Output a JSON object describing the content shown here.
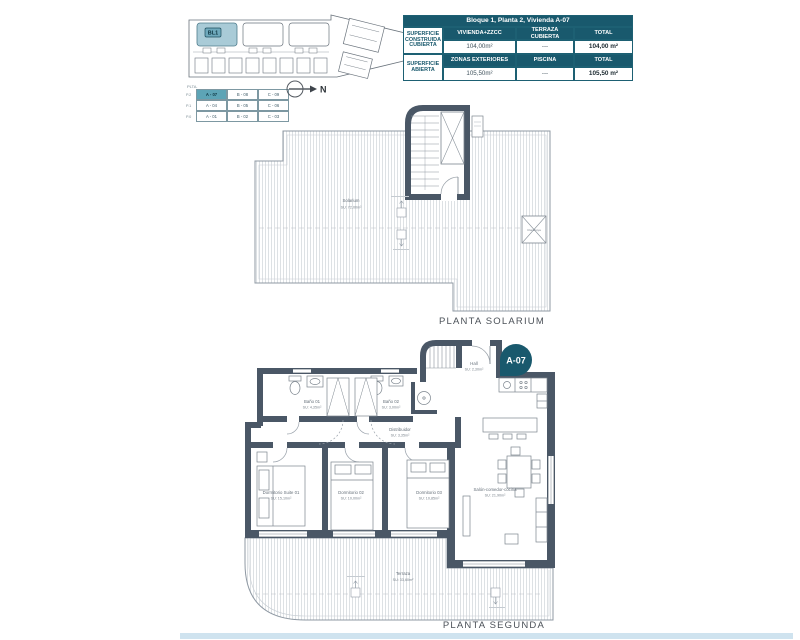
{
  "colors": {
    "teal_dark": "#19596d",
    "teal_cell": "#5da4b6",
    "wall": "#4a5766",
    "site_highlight": "#a9cbd7",
    "footer_blue": "#cfe3ef",
    "line_gray": "#8f99a3"
  },
  "site_plan": {
    "block_label": "BL1"
  },
  "compass": {
    "label": "N"
  },
  "legend": {
    "header": "PLTA.",
    "rows": [
      {
        "level": "P.2",
        "cells": [
          "A - 07",
          "B - 08",
          "C - 09"
        ]
      },
      {
        "level": "P.1",
        "cells": [
          "A - 04",
          "B - 05",
          "C - 06"
        ]
      },
      {
        "level": "P.0",
        "cells": [
          "A - 01",
          "B - 02",
          "C - 03"
        ]
      }
    ]
  },
  "summary_table": {
    "title": "Bloque 1, Planta 2, Vivienda A-07",
    "row1_label": "SUPERFICIE CONSTRUIDA CUBIERTA",
    "row1_headers": [
      "VIVIENDA+ZZCC",
      "TERRAZA CUBIERTA",
      "TOTAL"
    ],
    "row1_values": [
      "104,00m²",
      "---",
      "104,00 m²"
    ],
    "row2_label": "SUPERFICIE ABIERTA",
    "row2_headers": [
      "ZONAS EXTERIORES",
      "PISCINA",
      "TOTAL"
    ],
    "row2_values": [
      "105,50m²",
      "---",
      "105,50 m²"
    ]
  },
  "solarium": {
    "caption": "PLANTA SOLARIUM",
    "room": {
      "name": "Solarium",
      "area": "SU: 72,00m²"
    },
    "skylight": "Claraboya"
  },
  "segunda": {
    "caption": "PLANTA SEGUNDA",
    "badge": "A-07",
    "rooms": {
      "hall": {
        "name": "Hall",
        "area": "SU: 2,30m²"
      },
      "bano1": {
        "name": "Baño 01",
        "area": "SU: 4,35m²"
      },
      "bano2": {
        "name": "Baño 02",
        "area": "SU: 3,00m²"
      },
      "distribuidor": {
        "name": "Distribuidor",
        "area": "SU: 3,35m²"
      },
      "dorm1": {
        "name": "Dormitorio Suite 01",
        "area": "SU: 15,10m²"
      },
      "dorm2": {
        "name": "Dormitorio 02",
        "area": "SU: 10,00m²"
      },
      "dorm3": {
        "name": "Dormitorio 03",
        "area": "SU: 10,85m²"
      },
      "salon": {
        "name": "Salón-comedor-cocina",
        "area": "SU: 21,90m²"
      },
      "terraza": {
        "name": "Terraza",
        "area": "SU: 33,60m²"
      }
    }
  }
}
